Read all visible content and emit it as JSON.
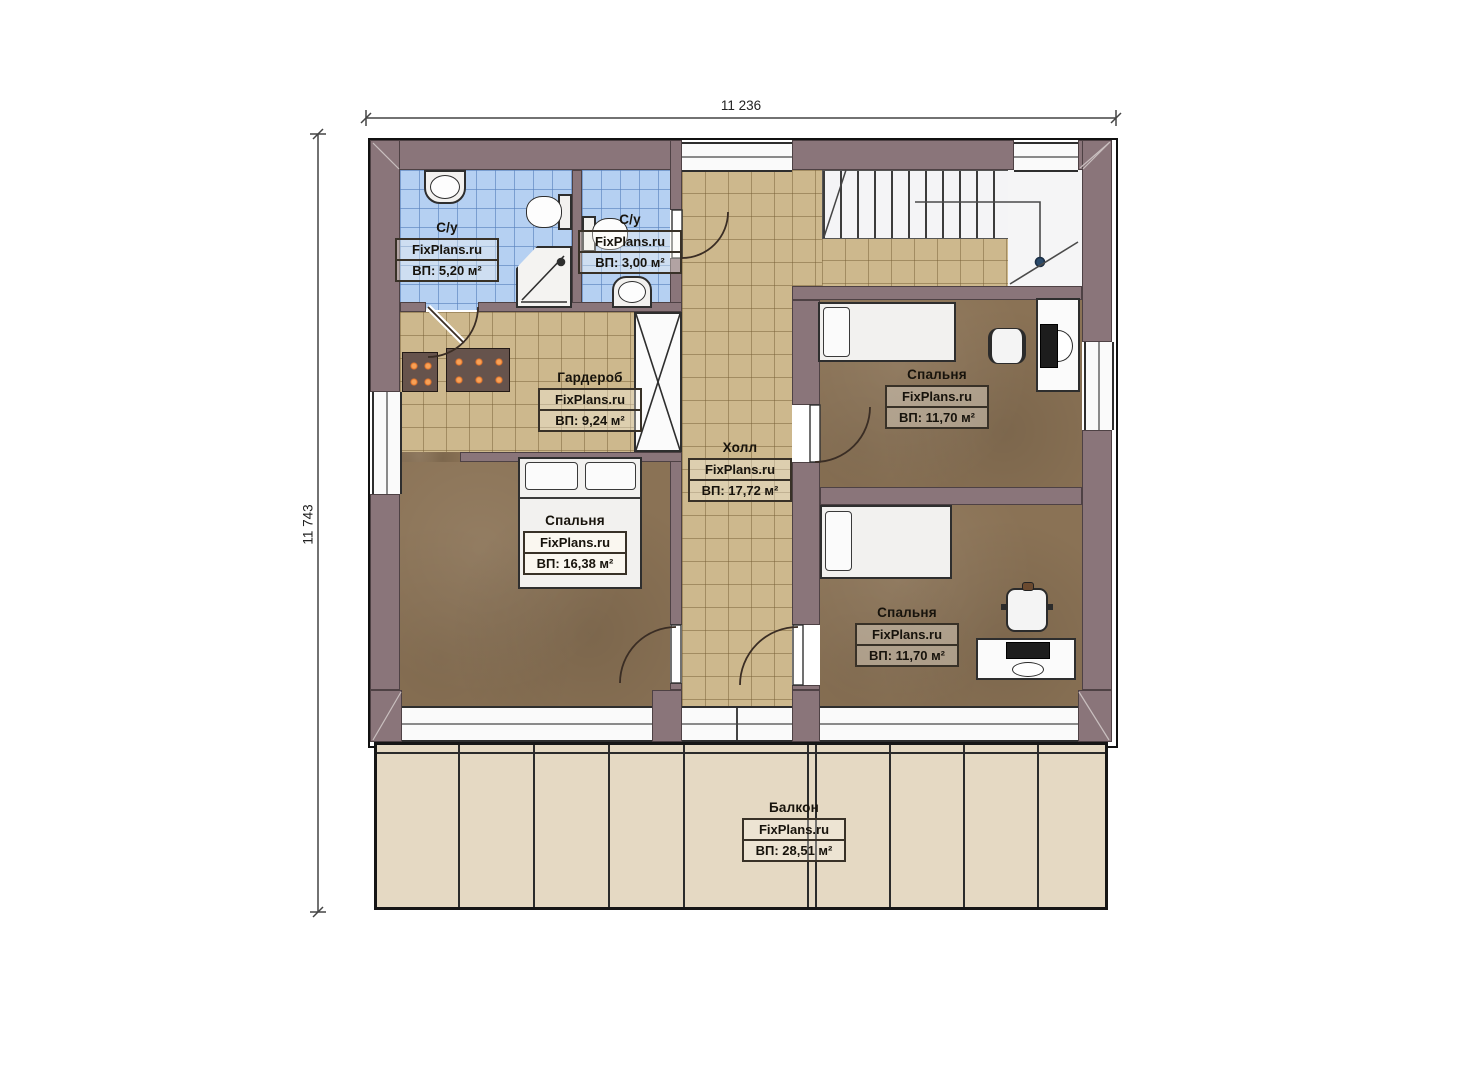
{
  "plan": {
    "brand": "FixPlans.ru",
    "dimensions": {
      "width_label": "11 236",
      "height_label": "11 743"
    },
    "rooms": [
      {
        "id": "bathroom-1",
        "name": "С/у",
        "brand": "FixPlans.ru",
        "area": "ВП: 5,20 м²"
      },
      {
        "id": "bathroom-2",
        "name": "С/у",
        "brand": "FixPlans.ru",
        "area": "ВП: 3,00 м²"
      },
      {
        "id": "wardrobe",
        "name": "Гардероб",
        "brand": "FixPlans.ru",
        "area": "ВП: 9,24 м²"
      },
      {
        "id": "hall",
        "name": "Холл",
        "brand": "FixPlans.ru",
        "area": "ВП: 17,72 м²"
      },
      {
        "id": "bedroom-top-right",
        "name": "Спальня",
        "brand": "FixPlans.ru",
        "area": "ВП: 11,70 м²"
      },
      {
        "id": "bedroom-master",
        "name": "Спальня",
        "brand": "FixPlans.ru",
        "area": "ВП: 16,38 м²"
      },
      {
        "id": "bedroom-bottom-right",
        "name": "Спальня",
        "brand": "FixPlans.ru",
        "area": "ВП: 11,70 м²"
      },
      {
        "id": "balcony",
        "name": "Балкон",
        "brand": "FixPlans.ru",
        "area": "ВП: 28,51 м²"
      }
    ],
    "colors": {
      "wall": "#8a757a",
      "bathroom_tile": "#b5d0f2",
      "hall_tile": "#cdb88d",
      "bedroom_floor": "#8a7255",
      "balcony_floor": "#e5d9c3",
      "accent_dots": "#f28b33"
    }
  }
}
